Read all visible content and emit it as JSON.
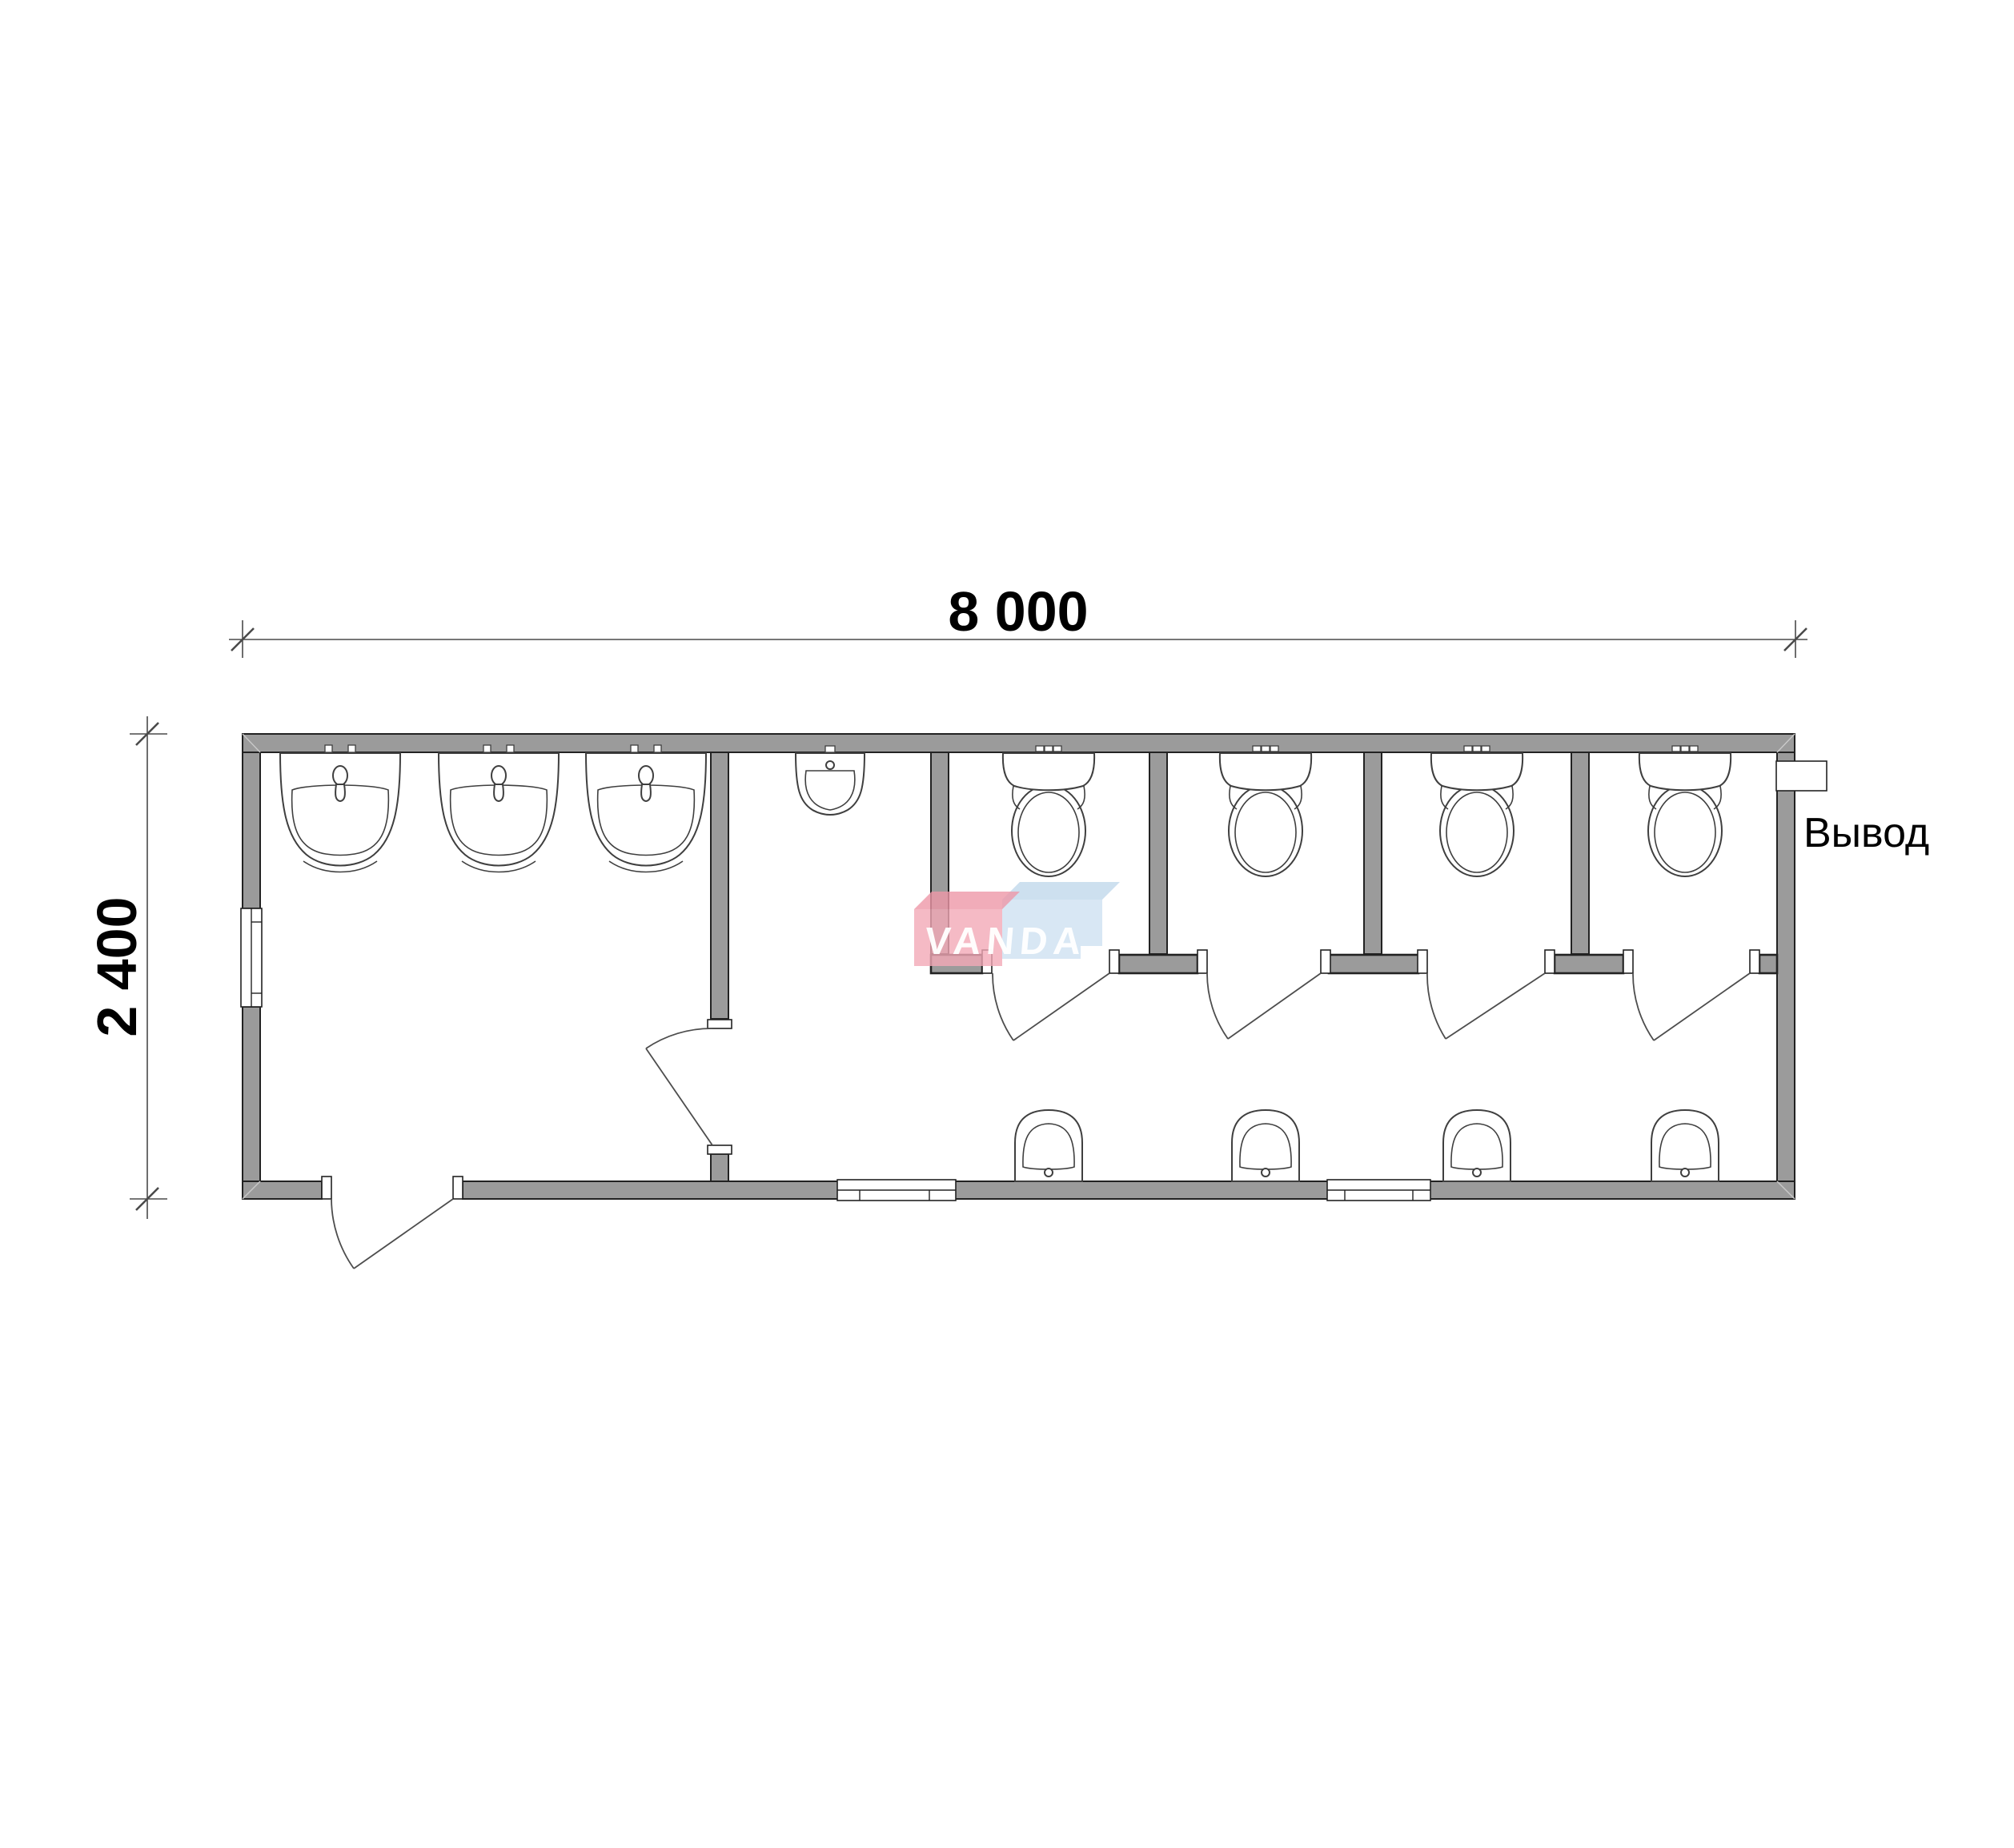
{
  "dimensions": {
    "width_label": "8 000",
    "height_label": "2 400"
  },
  "annotations": {
    "outlet_label": "Вывод"
  },
  "watermark": {
    "text": "VANDA"
  },
  "fixtures": {
    "washbasin_count": 3,
    "urinal_count": 1,
    "toilet_count": 4,
    "hand_basin_count": 4,
    "toilet_stall_count": 4
  },
  "colors": {
    "wall_fill": "#9b9b9b",
    "outline": "#222222",
    "fixture_stroke": "#3f3f3f",
    "door_stroke": "#4d4d4d",
    "dim_stroke": "#4a4a4a",
    "watermark_red": "#f2a9b6",
    "watermark_red_top": "#ee97a7",
    "watermark_blue": "#cfe2f2",
    "watermark_blue_top": "#c2d9ec",
    "watermark_text": "#ffffff"
  }
}
